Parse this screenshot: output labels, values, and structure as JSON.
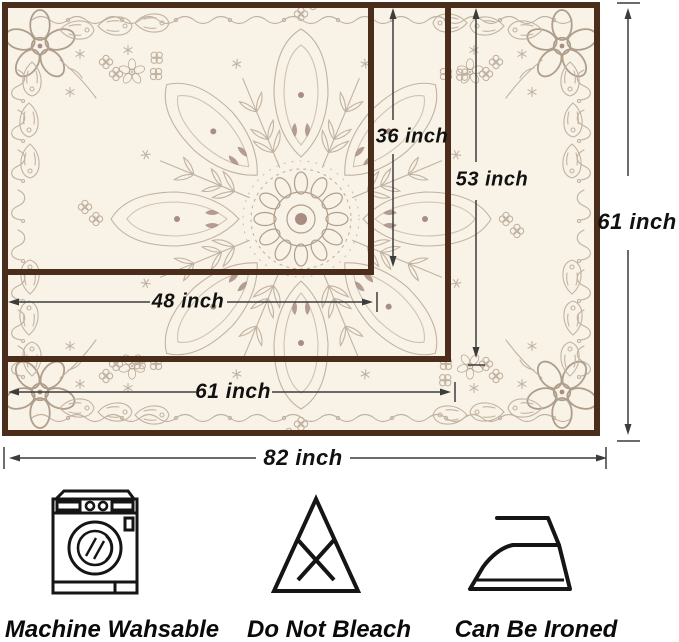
{
  "diagram": {
    "unit": "inch",
    "size_labels": {
      "inner_height": "36 inch",
      "middle_height": "53 inch",
      "outer_height": "61 inch",
      "inner_width": "48 inch",
      "middle_width": "61 inch",
      "outer_width": "82 inch"
    }
  },
  "care": {
    "items": [
      {
        "icon": "washing-machine-icon",
        "label": "Machine Wahsable"
      },
      {
        "icon": "do-not-bleach-icon",
        "label": "Do Not Bleach"
      },
      {
        "icon": "iron-icon",
        "label": "Can Be Ironed"
      }
    ]
  },
  "colors": {
    "cloth_border": "#4a2d1b",
    "cloth_background": "#f8f3e6",
    "pattern_taupe": "#c2b2a2",
    "pattern_accent": "#a78d82",
    "dimension_line": "#3c3c3c",
    "text": "#111111"
  }
}
